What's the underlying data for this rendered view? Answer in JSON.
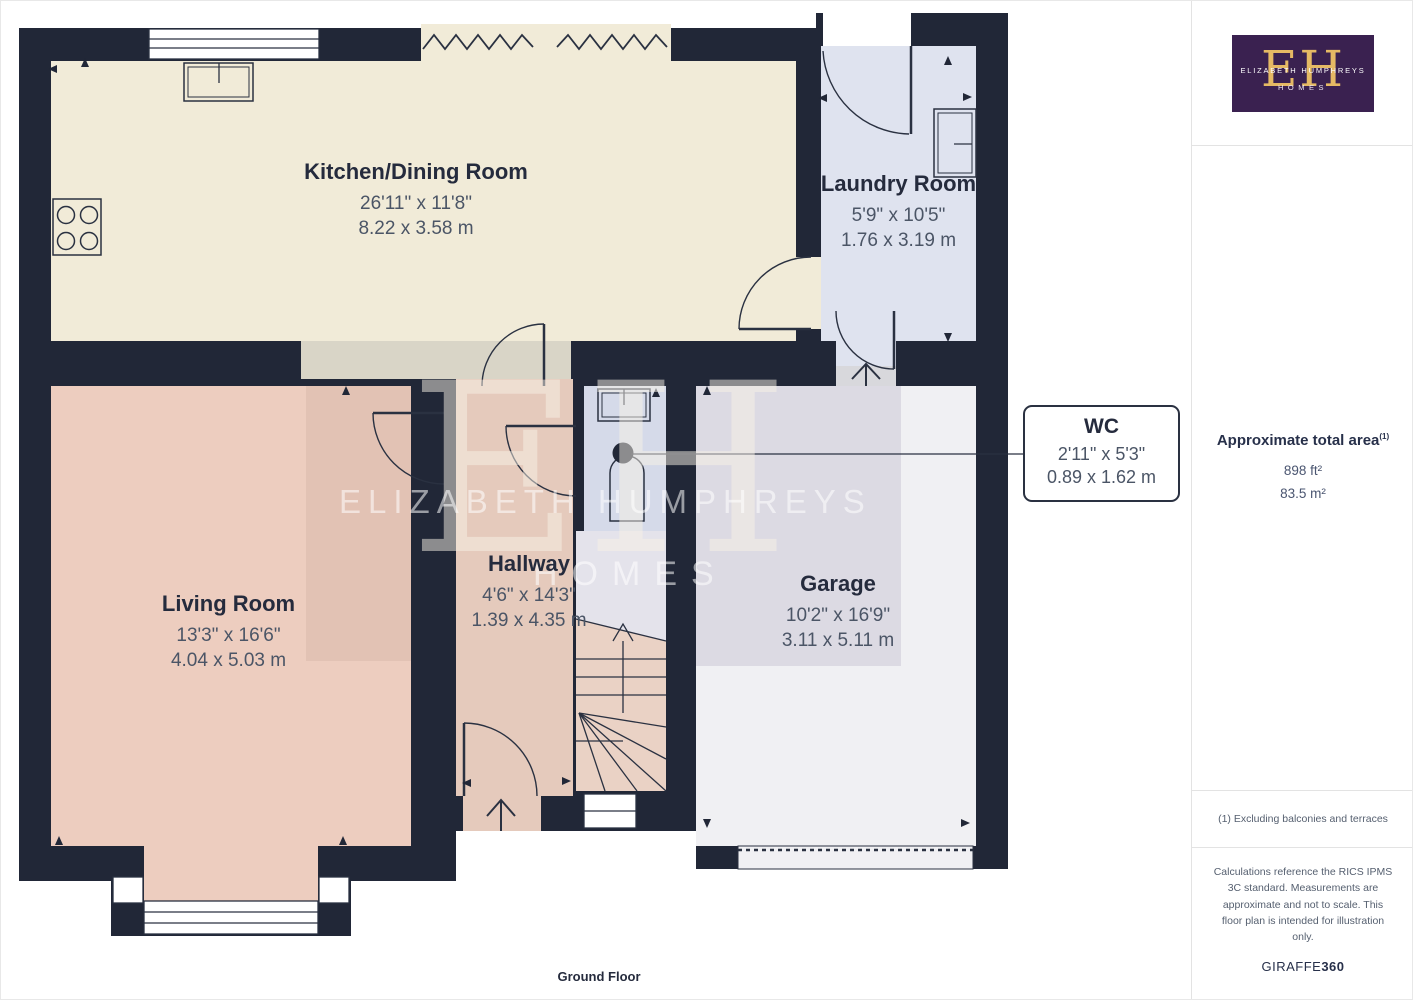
{
  "plan": {
    "floor_label": "Ground Floor",
    "rooms": [
      {
        "name": "Kitchen/Dining Room",
        "imperial": "26'11\" x 11'8\"",
        "metric": "8.22 x 3.58 m"
      },
      {
        "name": "Laundry Room",
        "imperial": "5'9\" x 10'5\"",
        "metric": "1.76 x 3.19 m"
      },
      {
        "name": "Living Room",
        "imperial": "13'3\" x 16'6\"",
        "metric": "4.04 x 5.03 m"
      },
      {
        "name": "Hallway",
        "imperial": "4'6\" x 14'3\"",
        "metric": "1.39 x 4.35 m"
      },
      {
        "name": "Garage",
        "imperial": "10'2\" x 16'9\"",
        "metric": "3.11 x 5.11 m"
      }
    ],
    "wc_callout": {
      "name": "WC",
      "imperial": "2'11\" x 5'3\"",
      "metric": "0.89 x 1.62 m"
    },
    "watermark": {
      "initials": "EH",
      "line1": "ELIZABETH HUMPHREYS",
      "line2": "HOMES"
    }
  },
  "sidebar": {
    "logo": {
      "initials": "EH",
      "name": "ELIZABETH HUMPHREYS",
      "subtitle": "HOMES"
    },
    "area": {
      "title": "Approximate total area",
      "title_superscript": "(1)",
      "imperial": "898 ft²",
      "metric": "83.5 m²"
    },
    "footnote": "(1) Excluding balconies and terraces",
    "disclaimer": "Calculations reference the RICS IPMS 3C standard. Measurements are approximate and not to scale. This floor plan is intended for illustration only.",
    "brand": {
      "name": "GIRAFFE",
      "suffix": "360"
    }
  },
  "colors": {
    "wall": "#212737",
    "kitchen_floor": "#F1EBD8",
    "kitchen_strip": "#D9D5C7",
    "laundry_floor": "#DFE3EF",
    "wc_floor": "#D5DAE9",
    "hallway_floor": "#E5CABC",
    "stairs_floor": "#EAD2C5",
    "living_floor": "#EDCDBF",
    "living_overlay": "#E2C2B4",
    "garage_floor": "#F0F0F3",
    "garage_overlay": "#DCDAE3",
    "logo_purple": "#3A2150",
    "logo_gold": "#E5B964",
    "label_dark": "#252B3D",
    "label_gray": "#4B5566"
  }
}
